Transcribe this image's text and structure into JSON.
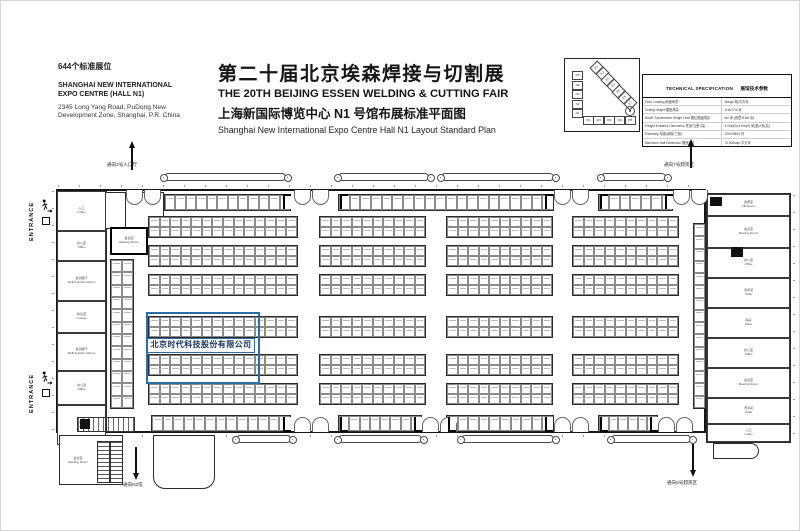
{
  "header": {
    "booth_count": "644个标准展位",
    "venue_line1": "SHANGHAI NEW INTERNATIONAL",
    "venue_line2": "EXPO CENTRE (HALL N1)",
    "addr_line1": "2345 Long Yang Road, PuDong New",
    "addr_line2": "Development Zone, Shanghai, P.R. China",
    "title_cn": "第二十届北京埃森焊接与切割展",
    "title_en": "THE 20TH BEIJING ESSEN WELDING & CUTTING FAIR",
    "subtitle_cn": "上海新国际博览中心 N1 号馆布展标准平面图",
    "subtitle_en": "Shanghai New International Expo Centre   Hall N1 Layout Standard Plan"
  },
  "sitemap": {
    "halls_n": [
      "N5",
      "N4",
      "N3",
      "N2",
      "N1"
    ],
    "halls_w": [
      "W1",
      "W2",
      "W3",
      "W4",
      "W5"
    ],
    "halls_e": [
      "E1",
      "E2",
      "E3",
      "E4",
      "E5",
      "E6",
      "E7"
    ]
  },
  "spec_table": {
    "title_en": "TECHNICAL SPECIFICATION",
    "title_cn": "展馆技术参数",
    "rows": [
      {
        "label": "Floor Loading  地面承重 :",
        "value": "3t/sqm  吨/平方米"
      },
      {
        "label": "Ceiling Height  展馆净高 :",
        "value": "11m/17m  米"
      },
      {
        "label": "Booth Construction Height Limit 展位搭建限高 :",
        "value": "6m 米 (双层 8.5m 米)"
      },
      {
        "label": "Freight Entrance Dimension 货运门(宽×高) :",
        "value": "4.0m(W)×4.5m(H)  米(宽)×米(高)"
      },
      {
        "label": "Electricity  电源(单相/三相) :",
        "value": "220V/380V  伏"
      },
      {
        "label": "Maximum Hall Dimension  展馆尺寸 :",
        "value": "70,500sqm  平方米"
      }
    ]
  },
  "plan": {
    "entrance_label": "ENTRANCE",
    "arrow_top_left": "通向2号入口厅",
    "arrow_top_right": "通向7号卸货区",
    "arrow_bottom_left": "通向N2馆",
    "arrow_bottom_right": "通向6号卸货区",
    "highlight": {
      "company": "北京时代科技股份有限公司",
      "color": "#2d6ca2"
    },
    "meeting_room": {
      "cn": "会议室",
      "en": "Meeting Room"
    },
    "lounge_room": {
      "cn": "休息室",
      "en": "Lounge"
    },
    "annex_room": {
      "cn": "会议室",
      "en": "Meeting Room"
    },
    "toilet_room": {
      "cn": "洗手间",
      "en": "Toilet"
    },
    "left_rooms": [
      {
        "cn": "入口",
        "en": "Lobby",
        "h": 40
      },
      {
        "cn": "办公室",
        "en": "Office",
        "h": 30
      },
      {
        "cn": "多功能厅",
        "en": "Multi-Function Room",
        "h": 40
      },
      {
        "cn": "休息室",
        "en": "Lounge",
        "h": 32
      },
      {
        "cn": "多功能厅",
        "en": "Multi-Function Room",
        "h": 38
      },
      {
        "cn": "办公室",
        "en": "Office",
        "h": 34
      },
      {
        "cn": "入口",
        "en": "Lobby",
        "h": 40
      }
    ],
    "right_rooms": [
      {
        "cn": "贵宾室",
        "en": "VIP Room",
        "h": 22
      },
      {
        "cn": "会议室",
        "en": "Meeting Room",
        "h": 32
      },
      {
        "cn": "办公室",
        "en": "Office",
        "h": 30
      },
      {
        "cn": "洗手间",
        "en": "Toilet",
        "h": 30
      },
      {
        "cn": "库房",
        "en": "Store",
        "h": 30
      },
      {
        "cn": "办公室",
        "en": "Office",
        "h": 30
      },
      {
        "cn": "会议室",
        "en": "Meeting Room",
        "h": 30
      },
      {
        "cn": "洗手间",
        "en": "Toilet",
        "h": 26
      },
      {
        "cn": "入口",
        "en": "Lobby",
        "h": 18
      }
    ]
  },
  "floorplan": {
    "hall": {
      "x": 55,
      "y": 188,
      "w": 650,
      "h": 244
    },
    "right_wing": {
      "x": 705,
      "y": 192,
      "w": 85,
      "h": 250
    },
    "bands_y": [
      215,
      244,
      273,
      315,
      353,
      382
    ],
    "groups": [
      {
        "x": 147,
        "w": 150,
        "cols": 14
      },
      {
        "x": 318,
        "w": 107,
        "cols": 10
      },
      {
        "x": 445,
        "w": 107,
        "cols": 10
      },
      {
        "x": 571,
        "w": 107,
        "cols": 10
      }
    ],
    "singles": [
      {
        "x": 163,
        "y": 193,
        "w": 127,
        "h": 17,
        "cols": 12,
        "rows": 1
      },
      {
        "x": 337,
        "y": 193,
        "w": 216,
        "h": 17,
        "cols": 20,
        "rows": 1
      },
      {
        "x": 597,
        "y": 193,
        "w": 75,
        "h": 17,
        "cols": 7,
        "rows": 1
      },
      {
        "x": 150,
        "y": 414,
        "w": 140,
        "h": 17,
        "cols": 13,
        "rows": 1
      },
      {
        "x": 337,
        "y": 414,
        "w": 84,
        "h": 17,
        "cols": 8,
        "rows": 1
      },
      {
        "x": 445,
        "y": 414,
        "w": 108,
        "h": 17,
        "cols": 10,
        "rows": 1
      },
      {
        "x": 597,
        "y": 414,
        "w": 60,
        "h": 17,
        "cols": 6,
        "rows": 1
      },
      {
        "x": 109,
        "y": 258,
        "w": 24,
        "h": 150,
        "cols": 2,
        "rows": 12
      },
      {
        "x": 692,
        "y": 222,
        "w": 13,
        "h": 186,
        "cols": 1,
        "rows": 15
      }
    ],
    "canopies_top": [
      {
        "x": 163,
        "w": 122
      },
      {
        "x": 337,
        "w": 91
      },
      {
        "x": 440,
        "w": 113
      },
      {
        "x": 600,
        "w": 65
      }
    ],
    "canopies_bottom": [
      {
        "x": 235,
        "w": 55
      },
      {
        "x": 337,
        "w": 84
      },
      {
        "x": 460,
        "w": 93
      },
      {
        "x": 610,
        "w": 80
      }
    ],
    "doors_top": [
      125,
      293,
      553,
      672
    ],
    "doors_bottom": [
      293,
      421,
      553,
      657
    ],
    "door_marks_top": [
      282,
      339,
      544,
      599,
      664
    ],
    "door_marks_bottom": [
      282,
      339,
      413,
      447,
      544,
      599,
      649
    ]
  }
}
